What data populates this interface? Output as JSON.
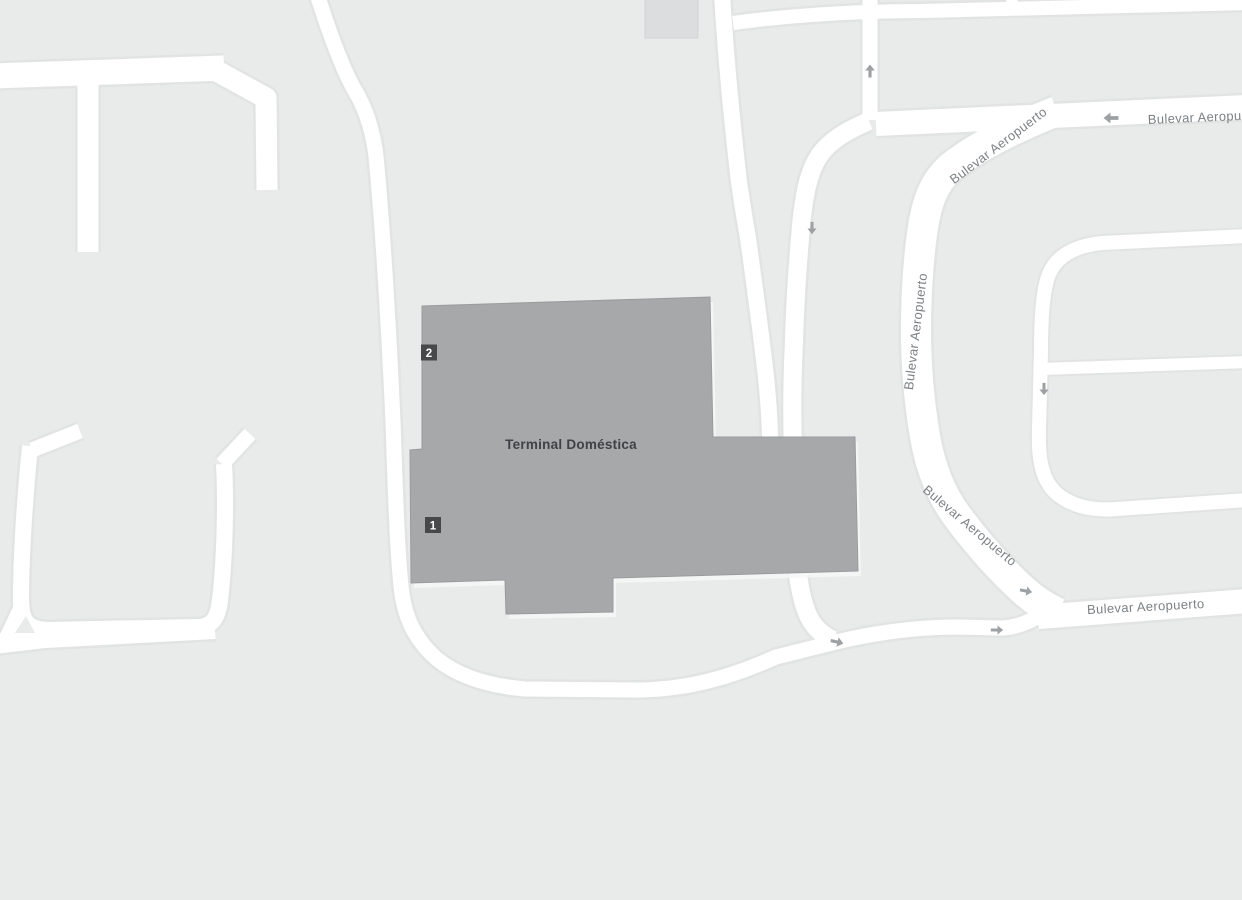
{
  "map": {
    "building": {
      "label": "Terminal Doméstica"
    },
    "road_name": "Bulevar Aeropuerto",
    "road_labels": [
      "Bulevar Aeropuerto",
      "Bulevar Aeropuerto",
      "Bulevar Aeropuerto",
      "Bulevar Aeropuerto",
      "Bulevar Aeropuerto"
    ],
    "markers": [
      {
        "number": "2"
      },
      {
        "number": "1"
      }
    ],
    "one_way_arrows": [
      "up",
      "left",
      "down",
      "down",
      "right",
      "right",
      "right"
    ],
    "colors": {
      "background": "#e9eaea",
      "road": "#ffffff",
      "road_casing": "#e2e3e3",
      "building_fill": "#a7a8a9",
      "building_outline": "#9a9b9d",
      "building_shadow": "#f6f7f7",
      "small_building_fill": "#dcddde",
      "marker_background": "#46484a",
      "marker_text": "#ffffff",
      "road_label_text": "#7d8184",
      "building_label_text": "#3f4245",
      "arrow": "#9da1a4"
    }
  }
}
